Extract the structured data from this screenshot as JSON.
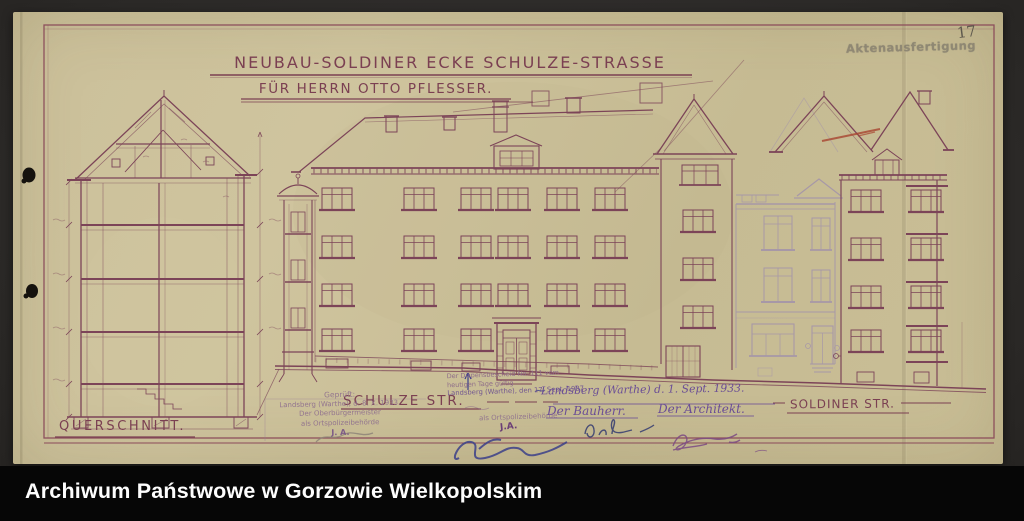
{
  "archive_bar": {
    "title": "Archiwum Państwowe w Gorzowie Wielkopolskim"
  },
  "sheet": {
    "page_number": "17",
    "file_stamp": "Aktenausfertigung",
    "title_line1": "NEUBAU-SOLDINER ECKE SCHULZE-STRASSE",
    "title_line2": "FÜR HERRN OTTO PFLESSER.",
    "label_section": "QUERSCHNITT.",
    "label_street_center": "SCHULZE STR.",
    "label_street_right": "SOLDINER STR.",
    "approval_stamp": {
      "l1": "Geprüft:",
      "l2": "Landsberg (Warthe), d. 8. X. 1933.",
      "l3": "Der Oberbürgermeister",
      "l4": "als Ortspolizeibehörde",
      "l5": "J. A."
    },
    "dispens_stamp": {
      "l1": "Der Dispensbescheid No. 111 vom",
      "l2": "heutigen Tage gültig",
      "l3": "Landsberg (Warthe), den 17. Sept. 1937",
      "l4": "als Ortspolizeibehörde",
      "l5": "J.A."
    },
    "handwriting": {
      "place_date": "Landsberg (Warthe) d. 1. Sept. 1933.",
      "owner_label": "Der Bauherr.",
      "architect_label": "Der Architekt."
    },
    "colors": {
      "paper": "#c9be96",
      "drawing_line": "#7c4458",
      "ink_blue": "#3b3f8a",
      "ink_purple": "#6a4d96",
      "pencil": "#8d8478",
      "red_pencil": "#a8432f",
      "stamp_gray": "#87806f",
      "caption_bg": "#060606",
      "backdrop": "#2e2b28"
    }
  }
}
